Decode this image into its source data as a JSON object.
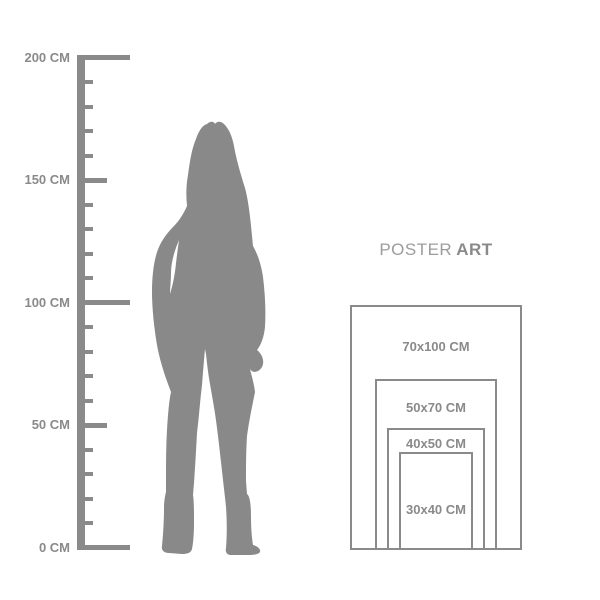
{
  "colors": {
    "primary_gray": "#8a8a8a",
    "silhouette_gray": "#898989",
    "poster_title_light_gray": "#9c9c9c",
    "background": "#ffffff"
  },
  "ruler": {
    "unit": "CM",
    "ticks": [
      {
        "cm": 200,
        "type": "major",
        "label": "200 CM"
      },
      {
        "cm": 190,
        "type": "minor"
      },
      {
        "cm": 180,
        "type": "minor"
      },
      {
        "cm": 170,
        "type": "minor"
      },
      {
        "cm": 160,
        "type": "minor"
      },
      {
        "cm": 150,
        "type": "mid",
        "label": "150 CM"
      },
      {
        "cm": 140,
        "type": "minor"
      },
      {
        "cm": 130,
        "type": "minor"
      },
      {
        "cm": 120,
        "type": "minor"
      },
      {
        "cm": 110,
        "type": "minor"
      },
      {
        "cm": 100,
        "type": "major",
        "label": "100 CM"
      },
      {
        "cm": 90,
        "type": "minor"
      },
      {
        "cm": 80,
        "type": "minor"
      },
      {
        "cm": 70,
        "type": "minor"
      },
      {
        "cm": 60,
        "type": "minor"
      },
      {
        "cm": 50,
        "type": "mid",
        "label": "50 CM"
      },
      {
        "cm": 40,
        "type": "minor"
      },
      {
        "cm": 30,
        "type": "minor"
      },
      {
        "cm": 20,
        "type": "minor"
      },
      {
        "cm": 10,
        "type": "minor"
      },
      {
        "cm": 0,
        "type": "major",
        "label": "0 CM"
      }
    ]
  },
  "poster_guide": {
    "title": {
      "light": "POSTER",
      "bold": "ART"
    },
    "sizes": [
      {
        "label": "70x100 CM",
        "width_cm": 70,
        "height_cm": 100
      },
      {
        "label": "50x70 CM",
        "width_cm": 50,
        "height_cm": 70
      },
      {
        "label": "40x50 CM",
        "width_cm": 40,
        "height_cm": 50
      },
      {
        "label": "30x40 CM",
        "width_cm": 30,
        "height_cm": 40
      }
    ]
  }
}
